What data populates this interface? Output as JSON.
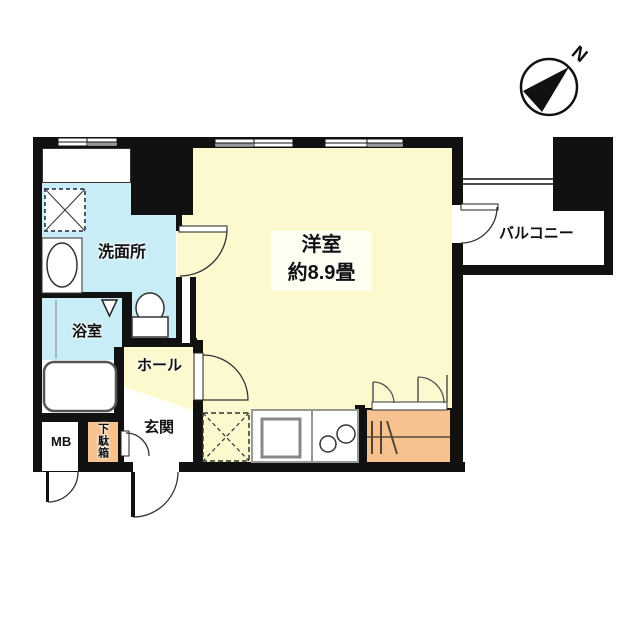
{
  "floor_plan": {
    "compass_label": "N",
    "rooms": {
      "main_room": {
        "label": "洋室",
        "size_label": "約8.9畳"
      },
      "washroom": {
        "label": "洗面所"
      },
      "bathroom": {
        "label": "浴室"
      },
      "hall": {
        "label": "ホール"
      },
      "entrance": {
        "label": "玄関"
      },
      "balcony": {
        "label": "バルコニー"
      },
      "meter_box": {
        "label": "MB"
      },
      "shoe_box": {
        "label": "下駄箱"
      }
    },
    "colors": {
      "wall": "#111111",
      "room_yellow": "#FCF9CE",
      "water_blue": "#C9EDF6",
      "storage_orange": "#F6C28F",
      "background": "#FFFFFF"
    }
  }
}
